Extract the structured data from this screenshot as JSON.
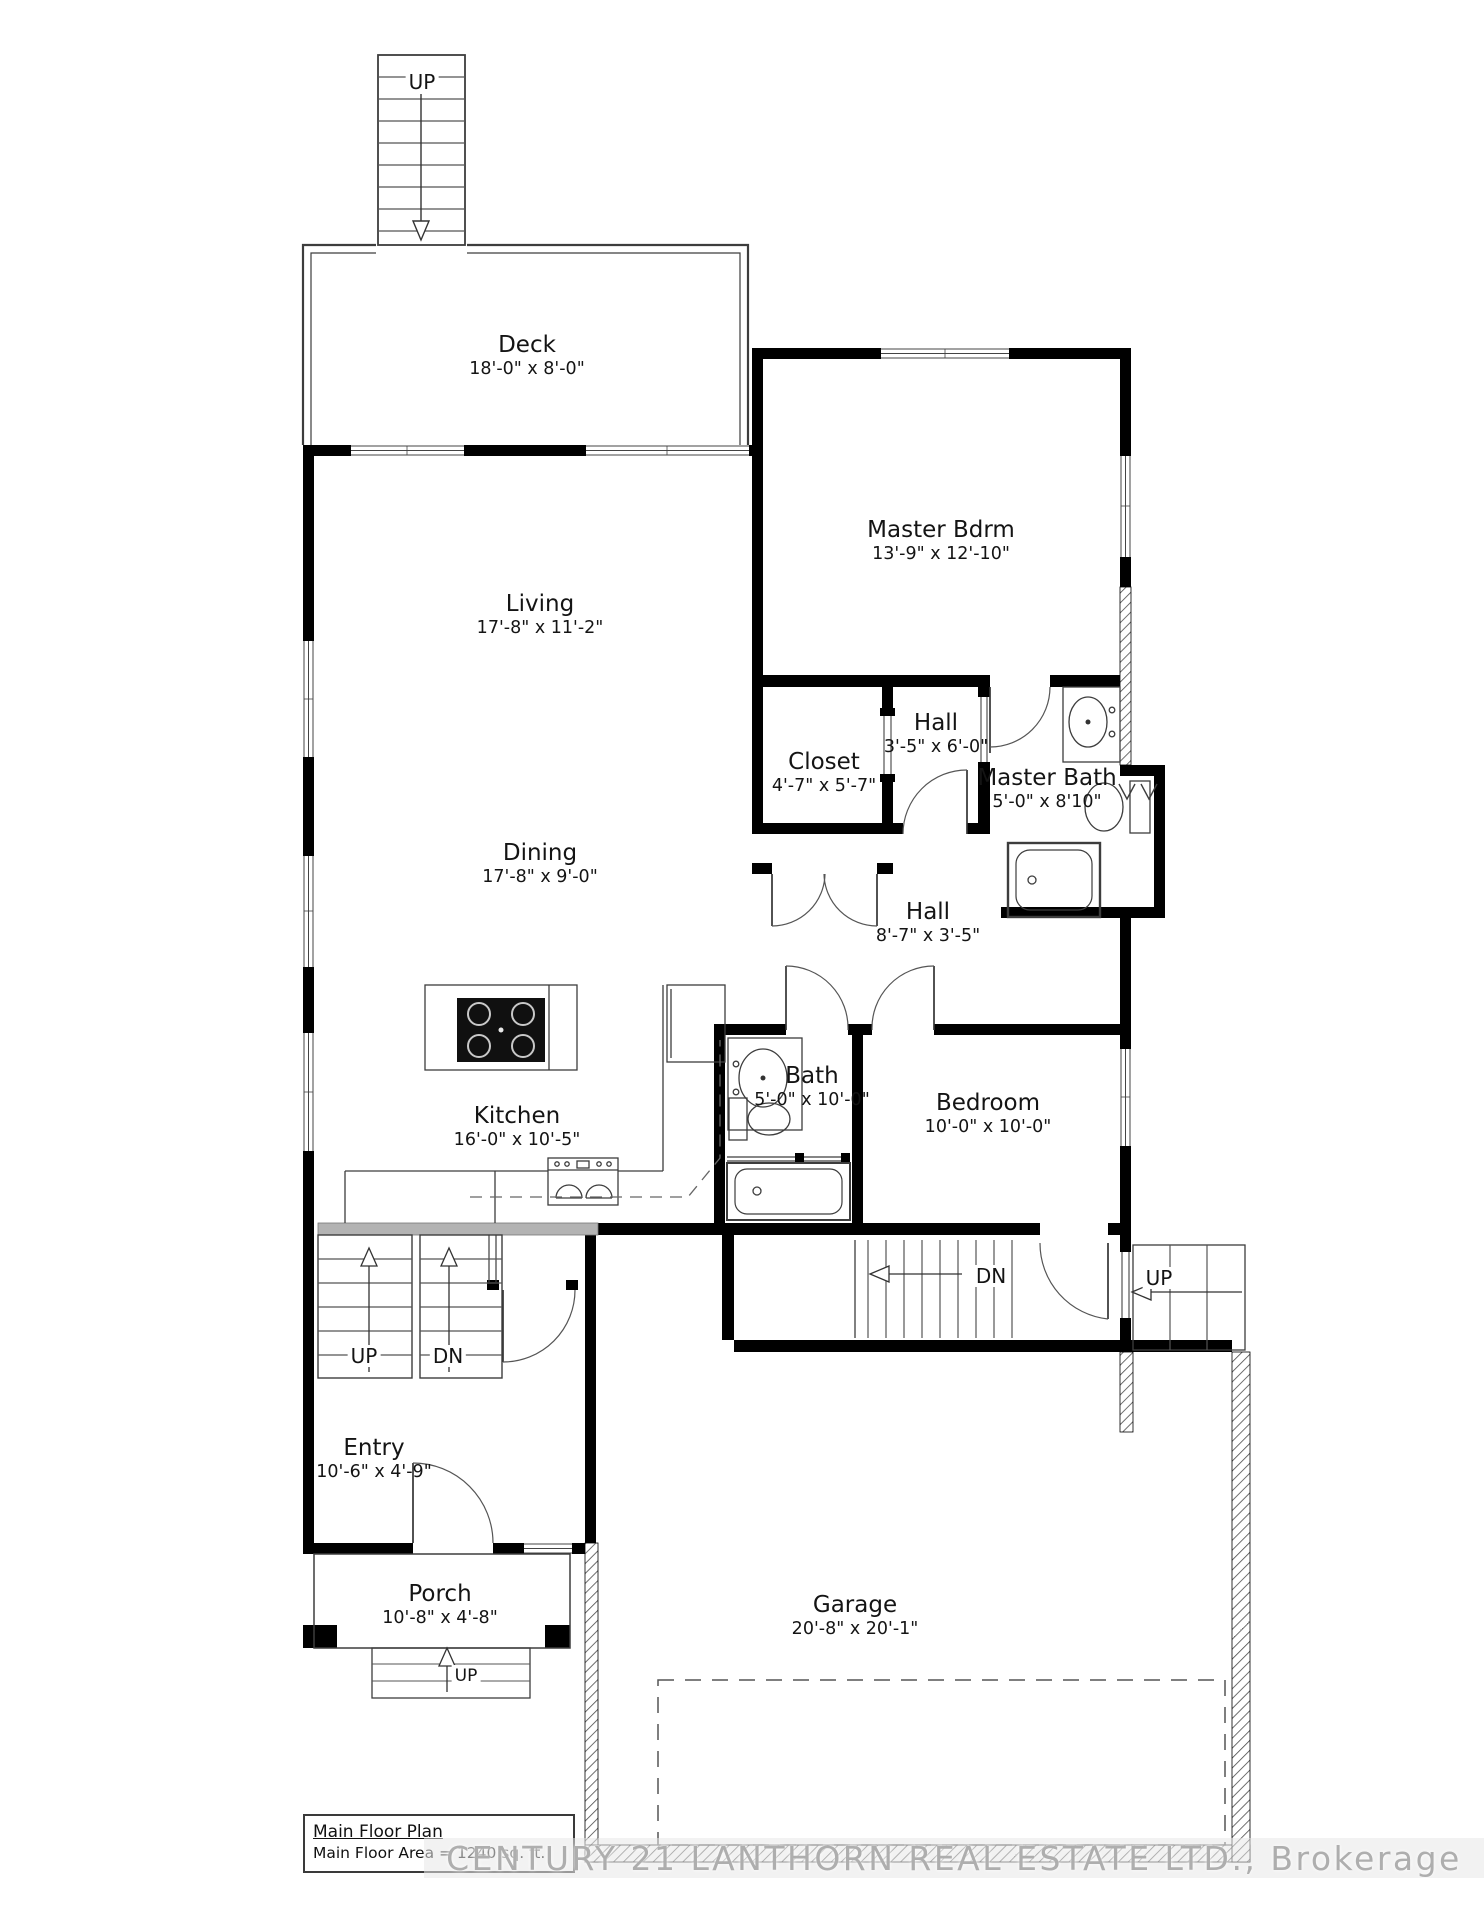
{
  "plan": {
    "title": "Main Floor Plan",
    "area_note": "Main Floor Area = 1240 sq. ft.",
    "watermark": "CENTURY 21 LANTHORN REAL ESTATE LTD., Brokerage"
  },
  "rooms": [
    {
      "id": "deck",
      "name": "Deck",
      "dims": "18'-0\" x 8'-0\""
    },
    {
      "id": "living",
      "name": "Living",
      "dims": "17'-8\" x 11'-2\""
    },
    {
      "id": "master-bdrm",
      "name": "Master Bdrm",
      "dims": "13'-9\" x 12'-10\""
    },
    {
      "id": "closet",
      "name": "Closet",
      "dims": "4'-7\" x 5'-7\""
    },
    {
      "id": "hall-upper",
      "name": "Hall",
      "dims": "3'-5\" x 6'-0\""
    },
    {
      "id": "master-bath",
      "name": "Master Bath",
      "dims": "5'-0\" x 8'10\""
    },
    {
      "id": "dining",
      "name": "Dining",
      "dims": "17'-8\" x 9'-0\""
    },
    {
      "id": "hall-lower",
      "name": "Hall",
      "dims": "8'-7\" x 3'-5\""
    },
    {
      "id": "kitchen",
      "name": "Kitchen",
      "dims": "16'-0\" x 10'-5\""
    },
    {
      "id": "bath",
      "name": "Bath",
      "dims": "5'-0\" x 10'-0\""
    },
    {
      "id": "bedroom",
      "name": "Bedroom",
      "dims": "10'-0\" x 10'-0\""
    },
    {
      "id": "entry",
      "name": "Entry",
      "dims": "10'-6\" x 4'-9\""
    },
    {
      "id": "porch",
      "name": "Porch",
      "dims": "10'-8\" x 4'-8\""
    },
    {
      "id": "garage",
      "name": "Garage",
      "dims": "20'-8\" x 20'-1\""
    }
  ],
  "stairs": {
    "deck_up": "UP",
    "entry_up": "UP",
    "entry_dn": "DN",
    "basement_dn": "DN",
    "side_up": "UP",
    "porch_up": "UP"
  },
  "colors": {
    "wall": "#000000",
    "header_gray": "#b3b3b3",
    "watermark_gray": "#aeaeae"
  }
}
